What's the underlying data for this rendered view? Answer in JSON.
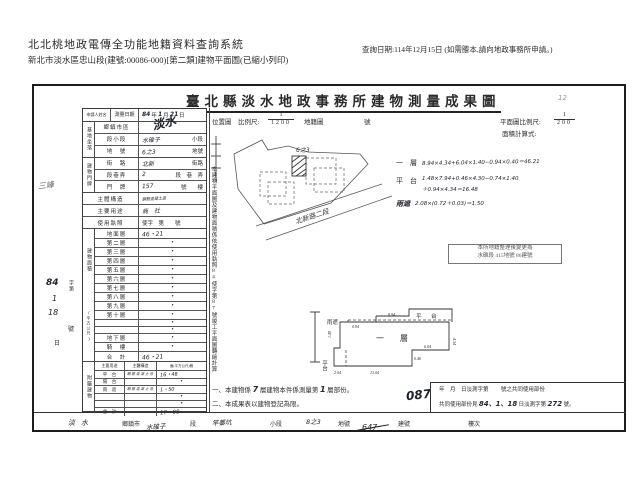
{
  "header": {
    "system_title": "北北桃地政電傳全功能地籍資料查詢系統",
    "doc_line": "新北市淡水區忠山段(建號:00086-000)[第二類]建物平面圖(已縮小列印)",
    "query_date": "查詢日期:114年12月15日 (如需謄本,請向地政事務所申請。)"
  },
  "doc": {
    "title": "臺北縣淡水地政事務所建物測量成果圖",
    "pencil_mark": "12"
  },
  "form": {
    "applicant_label": "申請人姓名",
    "survey_date_label": "測量日期",
    "survey_date": {
      "y": "84",
      "y_u": "年",
      "m": "1",
      "m_u": "月",
      "d": "21",
      "d_u": "日"
    },
    "site_group": "基地坐落",
    "site_rows": [
      {
        "label": "鄉鎮市區",
        "hand": "淡水",
        "print": ""
      },
      {
        "label": "段小段",
        "hand": "水碓子",
        "print": "小段"
      },
      {
        "label": "地　號",
        "hand": "6之3",
        "print": "地號"
      }
    ],
    "door_group": "建物門牌",
    "door_rows": [
      {
        "label": "街　路",
        "hand": "北新",
        "print": "街路"
      },
      {
        "label": "段巷弄",
        "hand": "2",
        "print": "段　巷　弄"
      },
      {
        "label": "門　牌",
        "hand": "157",
        "print": "號　　樓"
      }
    ],
    "structure_label": "主體構造",
    "structure_hand": "鋼筋混凝土造",
    "usage_label": "主要用途",
    "usage_hand": "商　社",
    "license_label": "使用執照",
    "license_value": "使字　第　　號",
    "area_group": "建物面積",
    "area_unit": "(平方公尺)",
    "floors": [
      {
        "label": "地面層",
        "value": "46・21"
      },
      {
        "label": "第二層",
        "value": "•"
      },
      {
        "label": "第三層",
        "value": "•"
      },
      {
        "label": "第四層",
        "value": "•"
      },
      {
        "label": "第五層",
        "value": "•"
      },
      {
        "label": "第六層",
        "value": "•"
      },
      {
        "label": "第七層",
        "value": "•"
      },
      {
        "label": "第八層",
        "value": "•"
      },
      {
        "label": "第九層",
        "value": "•"
      },
      {
        "label": "第十層",
        "value": "•"
      },
      {
        "label": "",
        "value": "•"
      },
      {
        "label": "",
        "value": "•"
      },
      {
        "label": "地下層",
        "value": "•"
      },
      {
        "label": "騎　樓",
        "value": "•"
      },
      {
        "label": "合　計",
        "value": "46・21"
      }
    ],
    "annex_group": "附屬建物",
    "annex_header": {
      "use": "主要用途",
      "struct": "主體構造",
      "area": "面(平方公尺)積"
    },
    "annex_rows": [
      {
        "use": "平　台",
        "struct": "鋼筋混凝土造",
        "area": "16・48"
      },
      {
        "use": "陽　台",
        "struct": "",
        "area": "•"
      },
      {
        "use": "雨　遮",
        "struct": "鋼筋混凝土造",
        "area": "1・50"
      },
      {
        "use": "",
        "struct": "",
        "area": "•"
      },
      {
        "use": "",
        "struct": "",
        "area": "•"
      },
      {
        "use": "合　計",
        "struct": "",
        "area": "17・98"
      }
    ]
  },
  "side_note": "本建物平面圖及建物面積係依使用執照84使字第87號竣工平面圖轉繪計算",
  "margin": {
    "scrawl": "三峰",
    "stamp_hand_y": "84",
    "stamp_hand_m": "1",
    "stamp_hand_d": "18",
    "stamp_print_1": "字第",
    "stamp_print_2": "號",
    "stamp_print_3": "日"
  },
  "scale": {
    "loc_label": "位置圖",
    "scale_label": "比例尺:",
    "scale_num": "1",
    "scale_den": "1200",
    "cad_label": "地籍圖",
    "cad_no_label": "號",
    "plan_scale_label": "平面圖比例尺:",
    "plan_num": "1",
    "plan_den": "200",
    "calc_label": "面積計算式:"
  },
  "map": {
    "road_label": "北新路二段",
    "lot_label": "6之3"
  },
  "calc": [
    {
      "label": "一　層",
      "lines": [
        "8.94×4.34+6.04×1.40−0.94×0.40＝46.21",
        "",
        ""
      ]
    },
    {
      "label": "平　台",
      "lines": [
        "1.48×7.94+0.46×4.30−0.74×1.40",
        "＋0.94×4.34＝16.48",
        ""
      ]
    },
    {
      "label": "雨遮",
      "lines": [
        "2.08×(0.72＋0.03)＝1.50",
        "",
        ""
      ]
    }
  ],
  "stamp_box": {
    "line1": "本所地籍整理後變更為",
    "line2": "水碓段 415地號 86建號"
  },
  "plan": {
    "floor": "一　層",
    "platform_top": "平　台",
    "platform_left": "平台",
    "canopy": "雨遮",
    "dims": [
      "8.94",
      "0.94",
      "4.34",
      "1.40",
      "2.04",
      "13.04",
      "6.04",
      "0.46"
    ]
  },
  "notes": {
    "n1a": "一、本建物係",
    "n1_hand1": "7",
    "n1b": "層建物本件係測量第",
    "n1_hand2": "1",
    "n1c": "層部份。",
    "n2": "二、本成果表以建物登記為限。",
    "big_hand": "087"
  },
  "share_box": {
    "l1a": "年　月　日淡測字第",
    "l1b": "號之共同使用部份",
    "l2a": "共同使用部份見",
    "l2_hand_date": "84、1、18",
    "l2b": "日淡測字第",
    "l2_hand_no": "272",
    "l2c": "號。"
  },
  "strip": {
    "items": [
      {
        "hand": "淡水",
        "label": "鄉鎮市"
      },
      {
        "hand": "水碓子",
        "label": "段"
      },
      {
        "hand": "竿蓁坑",
        "label": "小段"
      },
      {
        "hand": "8之3",
        "label": "地號"
      },
      {
        "hand": "647",
        "label": "建號"
      },
      {
        "hand": "",
        "label": "樓次"
      }
    ]
  }
}
